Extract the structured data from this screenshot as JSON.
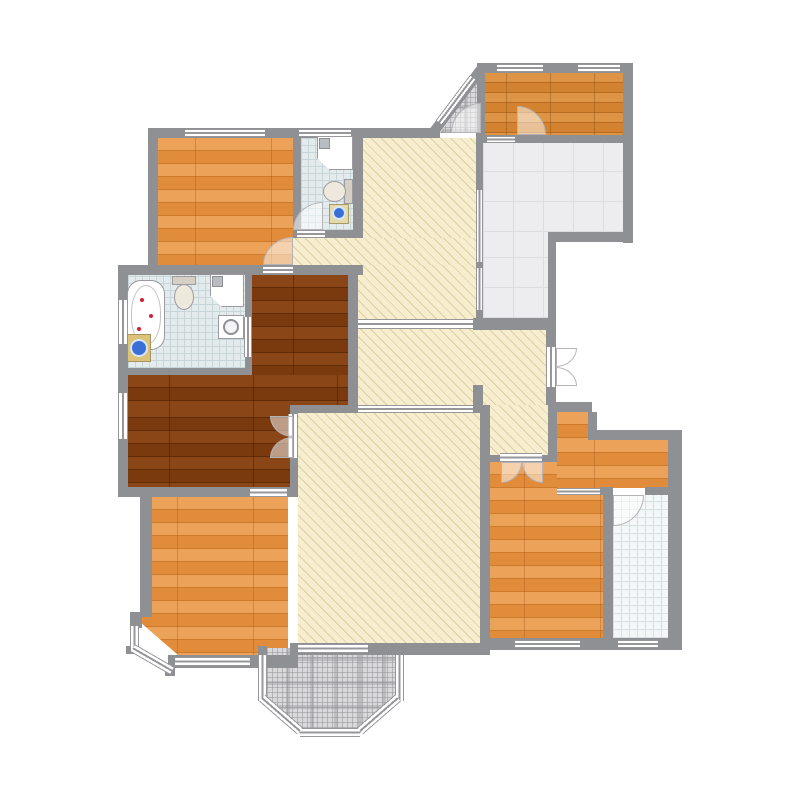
{
  "palette": {
    "bg": "#ffffff",
    "wall": "#8f9094",
    "cream": "#f6eecf",
    "cream-line": "#ddcfa2",
    "wood1": "#eda25a",
    "wood2": "#e18c3a",
    "wood-seam": "#cd7a2c",
    "dark1": "#8a4617",
    "dark2": "#7a3a0e",
    "dark-seam": "#5f2c08",
    "terra1": "#dd9444",
    "terra2": "#d3832f",
    "terra-seam": "#b56c22",
    "tile-base": "#e4ebed",
    "tile-line": "#c9d6d9",
    "terr-base": "#ededef",
    "terr-line": "#dddde0",
    "laun-base": "#f4f7f7",
    "laun-line": "#d7e0e0",
    "plaid-base": "#d9d9db",
    "washer-drum": "#3a6fd8",
    "petal": "#cc2233"
  },
  "plan": {
    "type": "residential-floor-plan",
    "rooms": [
      {
        "id": "bedroom-top-left",
        "floor": "hardwood-orange"
      },
      {
        "id": "bathroom-top",
        "floor": "ceramic-tile",
        "fixtures": [
          "shower",
          "toilet",
          "washing-machine"
        ]
      },
      {
        "id": "entry-vestibule",
        "floor": "stone-plaid"
      },
      {
        "id": "kitchen",
        "floor": "terracotta-tile"
      },
      {
        "id": "terrace",
        "floor": "large-grey-tile"
      },
      {
        "id": "upper-hallway",
        "floor": "parquet-cream"
      },
      {
        "id": "middle-hallway",
        "floor": "parquet-cream"
      },
      {
        "id": "en-suite-bathroom",
        "floor": "ceramic-tile",
        "fixtures": [
          "bathtub",
          "toilet",
          "shower",
          "washbasin",
          "washing-machine"
        ]
      },
      {
        "id": "master-bedroom",
        "floor": "hardwood-dark"
      },
      {
        "id": "living-room",
        "floor": "parquet-cream"
      },
      {
        "id": "bedroom-bottom-left",
        "floor": "hardwood-orange"
      },
      {
        "id": "bay-balcony",
        "floor": "stone-plaid"
      },
      {
        "id": "bedroom-bottom-right",
        "floor": "hardwood-orange"
      },
      {
        "id": "dressing-corridor",
        "floor": "hardwood-orange"
      },
      {
        "id": "laundry-bathroom",
        "floor": "ceramic-tile-white"
      }
    ],
    "doors": [
      "entry-swing",
      "kitchen-swing",
      "bathroom-top-swing",
      "bedroom-top-left-swing",
      "master-double-door",
      "bedroom-bottom-right-double-door",
      "laundry-swing",
      "hall-french-door"
    ],
    "window_count": 18
  }
}
